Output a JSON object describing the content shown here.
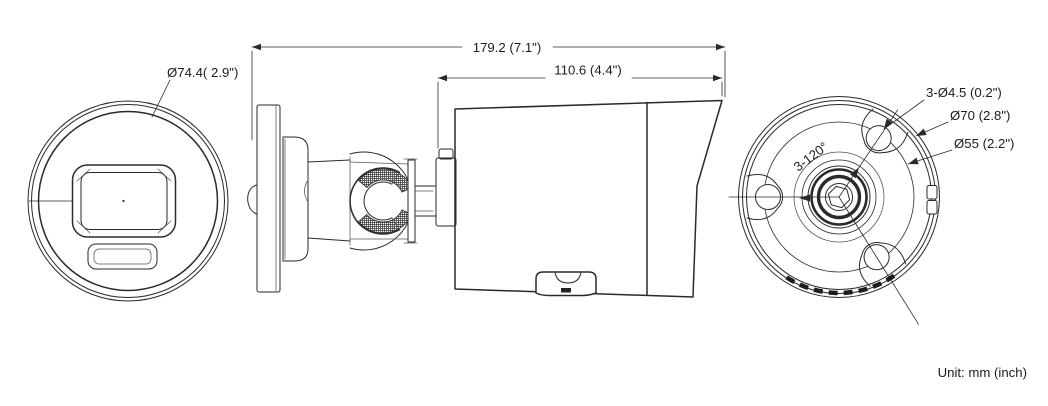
{
  "views": {
    "front": {
      "diameter_label": "Ø74.4( 2.9\")"
    },
    "side": {
      "total_length_label": "179.2 (7.1\")",
      "body_length_label": "110.6 (4.4\")"
    },
    "rear": {
      "mount_holes_label": "3-Ø4.5 (0.2\")",
      "bolt_circle_label": "Ø70 (2.8\")",
      "base_circle_label": "Ø55 (2.2\")",
      "hole_angle_label": "3-120°"
    }
  },
  "footnote": {
    "unit_label": "Unit: mm (inch)"
  },
  "colors": {
    "line": "#2a2a2a",
    "background": "#ffffff"
  }
}
